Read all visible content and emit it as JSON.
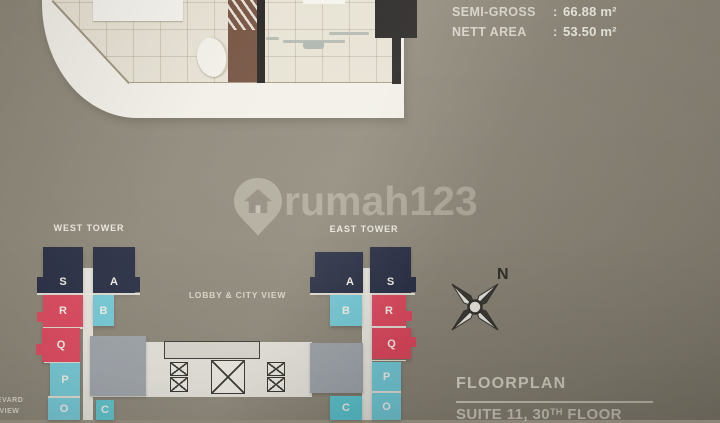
{
  "area_info": {
    "semi_gross_label": "SEMI-GROSS",
    "semi_gross_value": "66.88 m²",
    "nett_area_label": "NETT AREA",
    "nett_area_value": "53.50 m²",
    "separator": ":"
  },
  "watermark": {
    "brand": "rumah123"
  },
  "towers": {
    "west": {
      "label": "WEST TOWER",
      "units": [
        "S",
        "A",
        "R",
        "B",
        "Q",
        "P",
        "O",
        "C"
      ]
    },
    "east": {
      "label": "EAST TOWER",
      "units": [
        "A",
        "S",
        "B",
        "R",
        "Q",
        "P",
        "O",
        "C"
      ]
    }
  },
  "lobby_label": "LOBBY & CITY VIEW",
  "street_labels": {
    "line1": "LEVARD",
    "line2": "Y VIEW"
  },
  "compass": {
    "north": "N"
  },
  "footer": {
    "title": "FLOORPLAN",
    "subtitle_pre": "SUITE 11, 30",
    "subtitle_sup": "TH",
    "subtitle_post": " FLOOR"
  },
  "colors": {
    "background": "#8b8577",
    "tower_navy": "#242a41",
    "tower_red": "#de455c",
    "tower_blue": "#72cbd9",
    "tower_teal": "#5ac5d1",
    "core_gray": "#9ea4ab",
    "sheet_white": "#f2f0e9",
    "floor_beige": "#e6e1d3",
    "wardrobe_brown": "#6f4b3a",
    "wall_black": "#1d1c1b",
    "text_light": "#e6e2d7"
  }
}
